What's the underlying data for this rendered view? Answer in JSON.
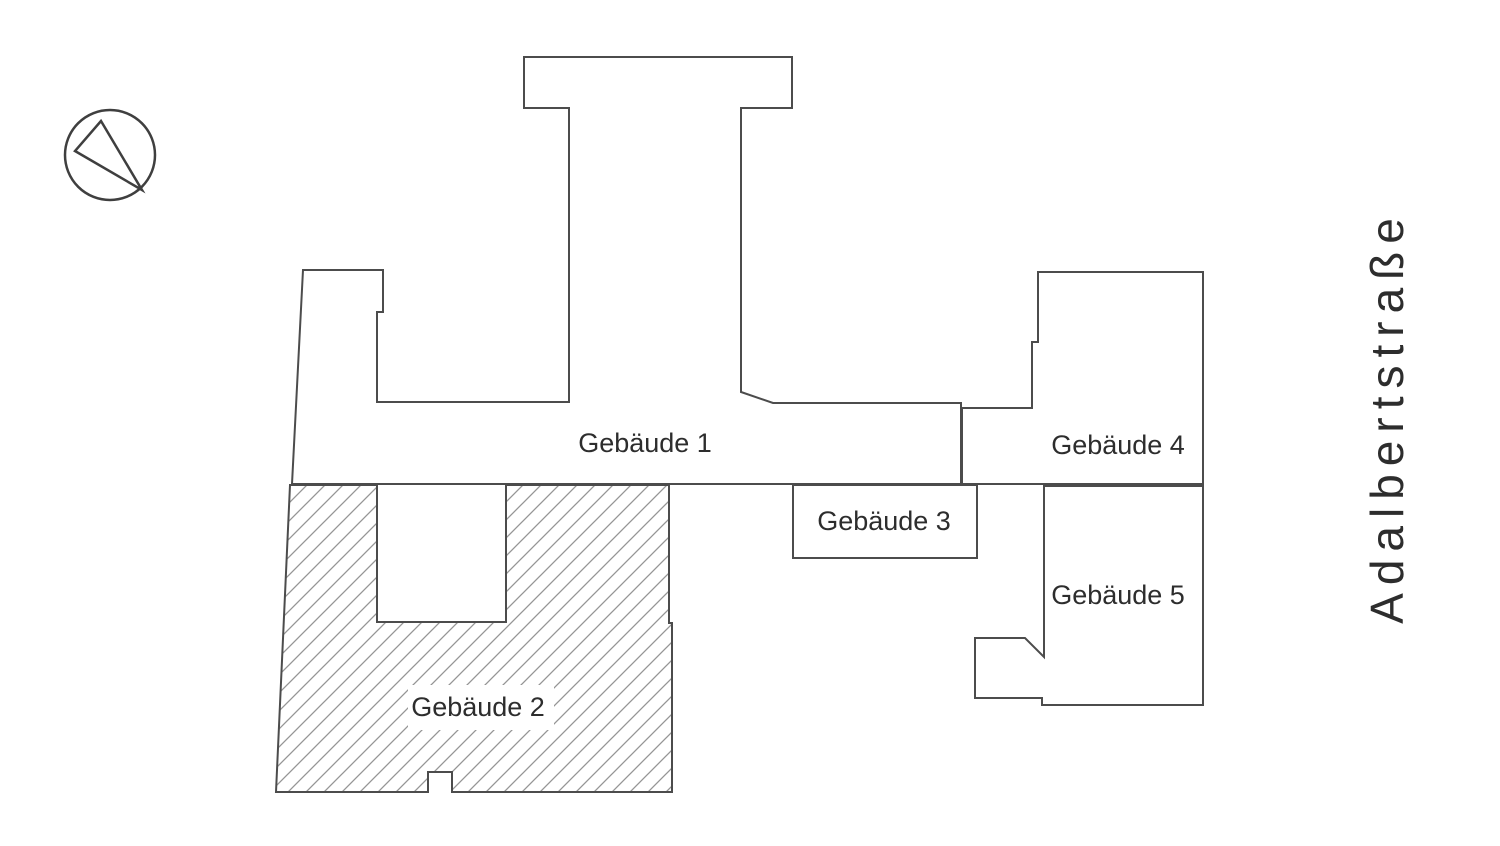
{
  "street": {
    "label": "Adalbertstraße"
  },
  "compass": {
    "icon": "north-arrow-icon"
  },
  "buildings": [
    {
      "id": "gebaeude-1",
      "label": "Gebäude 1",
      "hatched": false
    },
    {
      "id": "gebaeude-2",
      "label": "Gebäude 2",
      "hatched": true
    },
    {
      "id": "gebaeude-3",
      "label": "Gebäude 3",
      "hatched": false
    },
    {
      "id": "gebaeude-4",
      "label": "Gebäude 4",
      "hatched": false
    },
    {
      "id": "gebaeude-5",
      "label": "Gebäude 5",
      "hatched": false
    }
  ],
  "colors": {
    "background": "#ffffff",
    "outline": "#4c4c4c",
    "hatch": "#959595",
    "text": "#2d2d2d"
  }
}
